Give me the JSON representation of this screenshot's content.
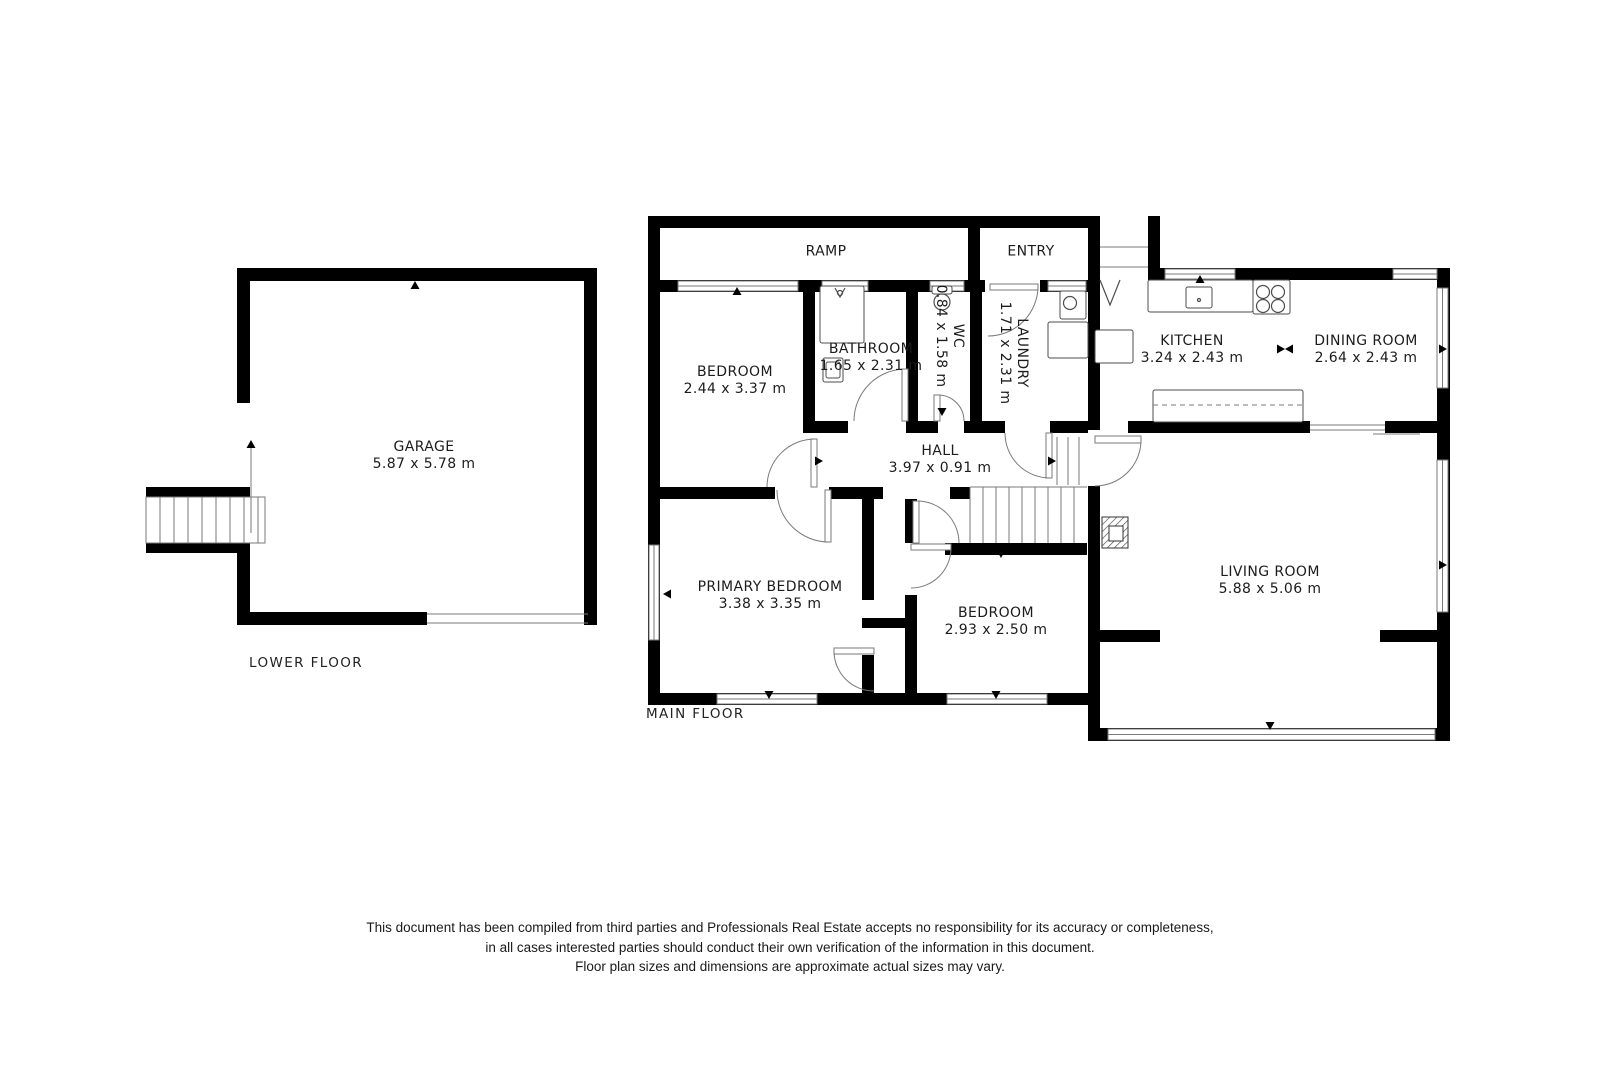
{
  "floor_labels": {
    "lower": "LOWER FLOOR",
    "main": "MAIN FLOOR"
  },
  "rooms": {
    "garage": {
      "name": "GARAGE",
      "dims": "5.87 x 5.78 m"
    },
    "ramp": {
      "name": "RAMP",
      "dims": ""
    },
    "entry": {
      "name": "ENTRY",
      "dims": ""
    },
    "bedroom1": {
      "name": "BEDROOM",
      "dims": "2.44 x 3.37 m"
    },
    "bathroom": {
      "name": "BATHROOM",
      "dims": "1.65 x 2.31 m"
    },
    "wc": {
      "name": "WC",
      "dims": "0.84 x 1.58 m"
    },
    "laundry": {
      "name": "LAUNDRY",
      "dims": "1.71 x 2.31 m"
    },
    "kitchen": {
      "name": "KITCHEN",
      "dims": "3.24 x 2.43 m"
    },
    "dining": {
      "name": "DINING ROOM",
      "dims": "2.64 x 2.43 m"
    },
    "hall": {
      "name": "HALL",
      "dims": "3.97 x 0.91 m"
    },
    "primary": {
      "name": "PRIMARY BEDROOM",
      "dims": "3.38 x 3.35 m"
    },
    "bedroom2": {
      "name": "BEDROOM",
      "dims": "2.93 x 2.50 m"
    },
    "living": {
      "name": "LIVING ROOM",
      "dims": "5.88 x 5.06 m"
    }
  },
  "disclaimer": [
    "This document has been compiled from third parties and Professionals Real Estate accepts no responsibility for its accuracy or completeness,",
    "in all cases interested parties should conduct their own verification of the information in this document.",
    "Floor plan sizes and dimensions are approximate actual sizes may vary."
  ],
  "colors": {
    "wall": "#000000",
    "line": "#7a7a7a",
    "fixture": "#4d4d4d",
    "background": "#ffffff"
  },
  "plan_geometry": {
    "walls": [
      [
        237,
        268,
        360,
        13
      ],
      [
        584,
        268,
        13,
        357
      ],
      [
        237,
        612,
        190,
        13
      ],
      [
        237,
        268,
        13,
        135
      ],
      [
        237,
        552,
        13,
        60
      ],
      [
        146,
        487,
        104,
        10
      ],
      [
        146,
        543,
        104,
        10
      ],
      [
        648,
        216,
        452,
        12
      ],
      [
        648,
        216,
        12,
        76
      ],
      [
        968,
        216,
        12,
        66
      ],
      [
        1088,
        216,
        12,
        214
      ],
      [
        648,
        280,
        452,
        12
      ],
      [
        1148,
        216,
        12,
        64
      ],
      [
        1148,
        268,
        302,
        12
      ],
      [
        1437,
        268,
        13,
        472
      ],
      [
        648,
        280,
        12,
        425
      ],
      [
        648,
        693,
        440,
        12
      ],
      [
        1088,
        728,
        362,
        13
      ],
      [
        1088,
        486,
        12,
        254
      ],
      [
        1100,
        630,
        60,
        12
      ],
      [
        1380,
        630,
        57,
        12
      ],
      [
        803,
        292,
        12,
        141
      ],
      [
        906,
        292,
        12,
        129
      ],
      [
        970,
        292,
        12,
        129
      ],
      [
        803,
        421,
        45,
        12
      ],
      [
        906,
        421,
        32,
        12
      ],
      [
        964,
        421,
        41,
        12
      ],
      [
        1050,
        421,
        38,
        12
      ],
      [
        648,
        487,
        127,
        12
      ],
      [
        829,
        487,
        54,
        12
      ],
      [
        950,
        487,
        20,
        12
      ],
      [
        862,
        499,
        12,
        101
      ],
      [
        862,
        655,
        12,
        38
      ],
      [
        905,
        499,
        12,
        44
      ],
      [
        905,
        595,
        12,
        98
      ],
      [
        862,
        618,
        55,
        10
      ],
      [
        945,
        543,
        142,
        12
      ],
      [
        1128,
        421,
        182,
        12
      ],
      [
        1385,
        421,
        52,
        12
      ]
    ],
    "openings": [
      [
        985,
        280,
        55,
        12
      ]
    ],
    "windows": [
      [
        678,
        281,
        120,
        10
      ],
      [
        822,
        281,
        46,
        10
      ],
      [
        930,
        281,
        34,
        10
      ],
      [
        1048,
        281,
        38,
        10
      ],
      [
        1165,
        269,
        70,
        10
      ],
      [
        1393,
        269,
        44,
        10
      ],
      [
        1437,
        288,
        11,
        100
      ],
      [
        1437,
        460,
        11,
        152
      ],
      [
        649,
        545,
        10,
        95
      ],
      [
        717,
        694,
        100,
        10
      ],
      [
        947,
        694,
        100,
        10
      ],
      [
        1108,
        729,
        327,
        11
      ]
    ],
    "thin_lines": [
      [
        427,
        614,
        588,
        614
      ],
      [
        427,
        623,
        588,
        623
      ],
      [
        1100,
        247,
        1148,
        247
      ],
      [
        1100,
        267,
        1148,
        267
      ],
      [
        1310,
        425,
        1385,
        425
      ],
      [
        1310,
        430,
        1385,
        430
      ],
      [
        1373,
        434,
        1420,
        434
      ],
      [
        251,
        443,
        251,
        533
      ],
      [
        970,
        487,
        1087,
        487
      ],
      [
        970,
        487,
        970,
        543
      ],
      [
        1053,
        324,
        1053,
        356
      ]
    ],
    "stairs": [
      {
        "x": 146,
        "y": 497,
        "w": 119,
        "h": 46,
        "step": 14,
        "outline": true
      },
      {
        "x": 970,
        "y": 487,
        "w": 117,
        "h": 56,
        "step": 13,
        "outline": false
      },
      {
        "x": 1046,
        "y": 437,
        "w": 44,
        "h": 48,
        "step": 11,
        "outline": false
      }
    ],
    "leaves": [
      [
        990,
        284,
        48,
        6
      ],
      [
        811,
        439,
        6,
        48
      ],
      [
        825,
        490,
        6,
        52
      ],
      [
        902,
        369,
        6,
        52
      ],
      [
        934,
        395,
        6,
        26
      ],
      [
        1046,
        433,
        6,
        45
      ],
      [
        1095,
        436,
        46,
        7
      ],
      [
        911,
        544,
        40,
        6
      ],
      [
        834,
        648,
        40,
        6
      ],
      [
        913,
        501,
        6,
        42
      ]
    ],
    "arcs": [
      "M1038,286 A50,50 0 0 1 988,336",
      "M815,439 A48,48 0 0 0 767,487",
      "M829,542 A52,52 0 0 1 777,490",
      "M906,369 A52,52 0 0 0 854,421",
      "M938,395 A26,26 0 0 1 964,421",
      "M1050,478 A45,45 0 0 1 1005,433",
      "M1141,440 A46,46 0 0 1 1095,486",
      "M951,548 A40,40 0 0 1 911,588",
      "M834,651 A40,40 0 0 0 874,691",
      "M917,501 A42,42 0 0 1 959,543"
    ],
    "fixtures": [
      [
        820,
        286,
        44,
        57
      ],
      [
        823,
        358,
        20,
        24
      ],
      [
        826,
        362,
        14,
        16
      ],
      [
        932,
        286,
        20,
        8
      ],
      [
        1060,
        291,
        26,
        28
      ],
      [
        1048,
        322,
        40,
        36
      ],
      [
        1095,
        330,
        38,
        33
      ],
      [
        1148,
        280,
        105,
        32
      ],
      [
        1253,
        280,
        37,
        34
      ],
      [
        1186,
        287,
        26,
        21
      ],
      [
        1153,
        390,
        150,
        32
      ]
    ],
    "circles": [
      [
        1263,
        292,
        6.5
      ],
      [
        1278,
        292,
        6.5
      ],
      [
        1263,
        306,
        6.5
      ],
      [
        1278,
        306,
        6.5
      ],
      [
        942,
        302,
        8
      ],
      [
        1070,
        303,
        6.5
      ],
      [
        1199,
        300,
        1.5
      ],
      [
        840,
        293,
        2.5
      ]
    ],
    "dashed_lines": [
      [
        1153,
        405,
        1303,
        405
      ]
    ],
    "detail_paths": [
      "M1100,280 L1110,305 L1120,280",
      "M835,288 L840,297 L845,288"
    ],
    "fireplace": {
      "outer": [
        1102,
        517,
        26,
        31
      ],
      "inner": [
        1109,
        526,
        14,
        15
      ]
    },
    "ticks": [
      [
        415,
        281,
        "up"
      ],
      [
        595,
        437,
        "right"
      ],
      [
        416,
        624,
        "down"
      ],
      [
        251,
        440,
        "up"
      ],
      [
        737,
        287,
        "up"
      ],
      [
        1200,
        275,
        "up"
      ],
      [
        1364,
        272,
        "up"
      ],
      [
        769,
        699,
        "down"
      ],
      [
        996,
        699,
        "down"
      ],
      [
        1270,
        730,
        "down"
      ],
      [
        663,
        594,
        "left"
      ],
      [
        1447,
        349,
        "right"
      ],
      [
        1447,
        565,
        "right"
      ],
      [
        1001,
        558,
        "down"
      ],
      [
        942,
        416,
        "down"
      ],
      [
        823,
        461,
        "right"
      ],
      [
        1056,
        461,
        "right"
      ],
      [
        1285,
        349,
        "left"
      ],
      [
        1285,
        349,
        "right"
      ]
    ]
  }
}
